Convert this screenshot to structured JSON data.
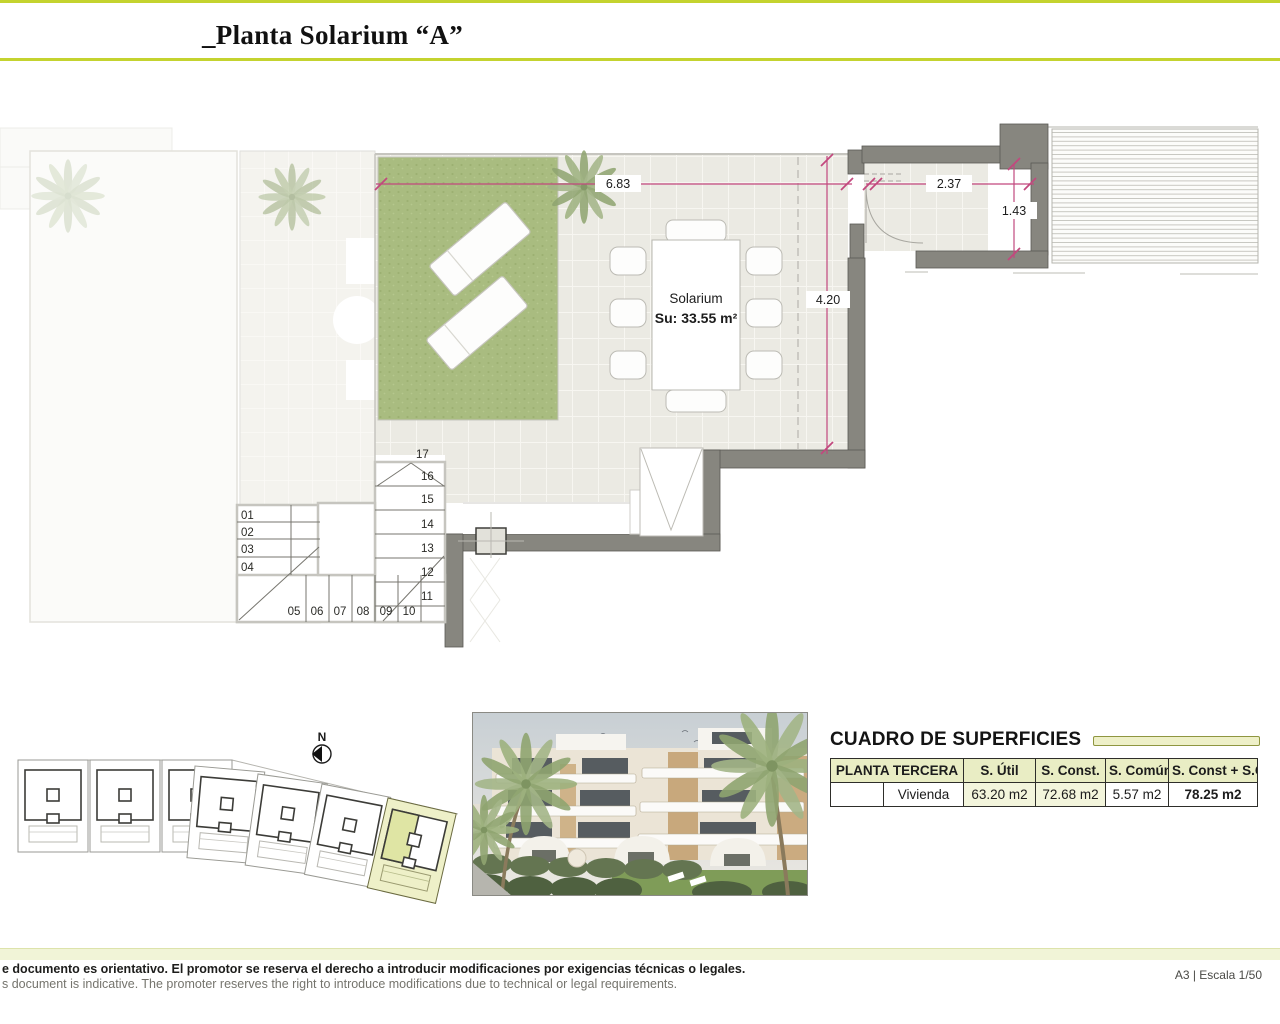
{
  "header": {
    "title": "_Planta Solarium “A”"
  },
  "plan": {
    "room_label": "Solarium",
    "room_area": "Su: 33.55 m²",
    "dim_total_width": "6.83",
    "dim_depth": "4.20",
    "dim_room_width": "2.37",
    "dim_room_depth": "1.43",
    "stair_steps": [
      "01",
      "02",
      "03",
      "04",
      "05",
      "06",
      "07",
      "08",
      "09",
      "10",
      "11",
      "12",
      "13",
      "14",
      "15",
      "16",
      "17"
    ]
  },
  "site_plan": {
    "north_label": "N",
    "icons": {
      "north_arrow": "compass-left-triangle"
    }
  },
  "surfaces": {
    "title": "CUADRO DE SUPERFICIES",
    "columns": [
      "PLANTA TERCERA",
      "S. Útil",
      "S. Const.",
      "S. Común",
      "S. Const + S.C"
    ],
    "rows": [
      {
        "name": "Vivienda",
        "util": "63.20 m2",
        "const": "72.68 m2",
        "comun": "5.57 m2",
        "total": "78.25 m2"
      }
    ]
  },
  "footer": {
    "disclaimer_es": "e documento es orientativo. El promotor se reserva el derecho a introducir modificaciones por exigencias técnicas o legales.",
    "disclaimer_en": "s document is indicative. The promoter reserves the right to introduce modifications due to technical or legal requirements.",
    "sheet_info": "A3 | Escala 1/50"
  },
  "colors": {
    "accent_green": "#c4d32f",
    "pale_green": "#eef0c8",
    "table_header_green": "#e9edc4",
    "highlight_unit_green": "#dfe5a4",
    "dimension_pink": "#c2487e",
    "wall_gray": "#87867f",
    "grass_green": "#a9bc80",
    "tile_beige": "#ebeae3"
  }
}
